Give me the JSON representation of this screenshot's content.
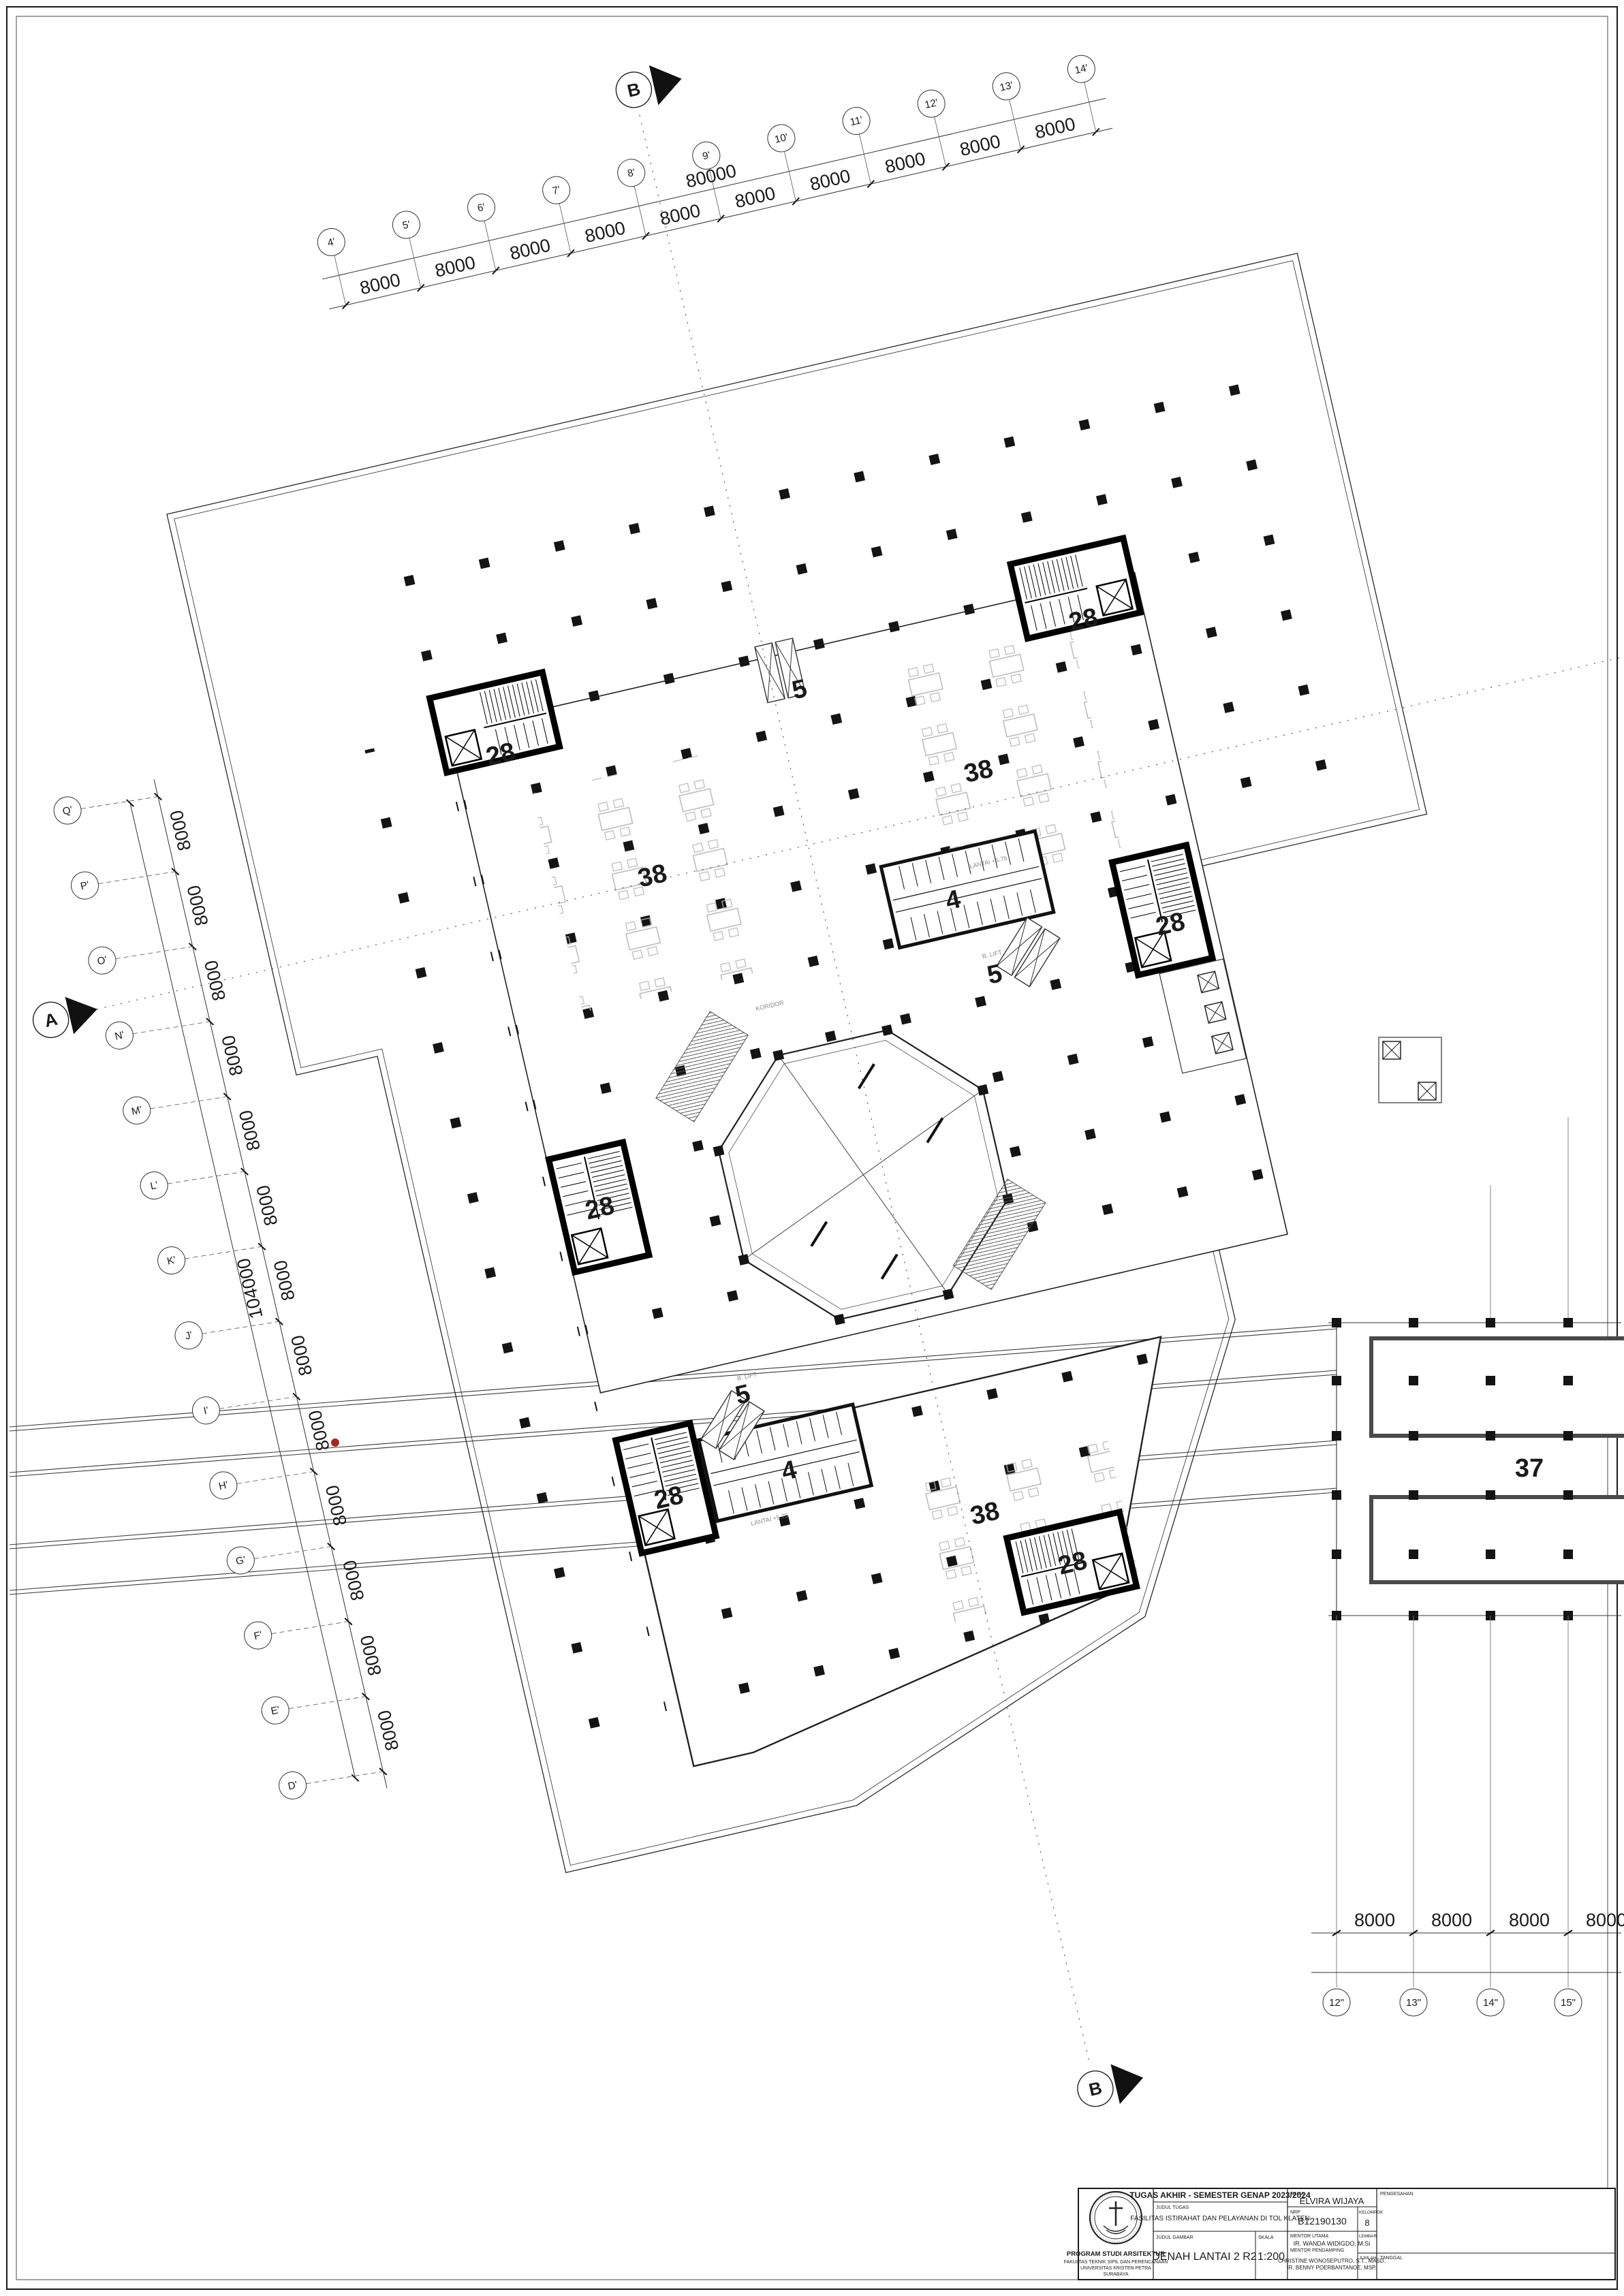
{
  "sheet": {
    "drawing_type": "architectural-floor-plan",
    "colors": {
      "ink": "#1a1a1a",
      "thin": "#333333",
      "furniture": "#b8b8b8",
      "red_mark": "#9e2b25"
    }
  },
  "plan": {
    "section_a": "A",
    "section_b": "B",
    "rooms": {
      "stair": "28",
      "dining": "38",
      "toilet": "4",
      "escalator": "5",
      "wing": "37"
    },
    "notes": {
      "lift": "B. LIFT",
      "level": "LANTAI +5.75",
      "corridor": "KORIDOR"
    }
  },
  "grid": {
    "bay": "8000",
    "total_left": "104000",
    "total_top": "80000",
    "top_labels": [
      "4'",
      "5'",
      "6'",
      "7'",
      "8'",
      "9'",
      "10'",
      "11'",
      "12'",
      "13'",
      "14'"
    ],
    "left_labels": [
      "Q'",
      "P'",
      "O'",
      "N'",
      "M'",
      "L'",
      "K'",
      "J'",
      "I'",
      "H'",
      "G'",
      "F'",
      "E'",
      "D'"
    ],
    "bottom_labels": [
      "12\"",
      "13\"",
      "14\"",
      "15\""
    ]
  },
  "title_block": {
    "header": "TUGAS AKHIR - SEMESTER GENAP 2023/2024",
    "judul_tugas_label": "JUDUL TUGAS",
    "judul_tugas": "FASILITAS ISTIRAHAT DAN PELAYANAN DI TOL KLATEN",
    "judul_gambar_label": "JUDUL GAMBAR",
    "judul_gambar": "DENAH LANTAI 2 R2",
    "skala_label": "SKALA",
    "skala": "1:200",
    "nama_label": "NAMA",
    "nama": "ELVIRA WIJAYA",
    "nrp_label": "NRP",
    "nrp": "B12190130",
    "kelompok_label": "KELOMPOK",
    "kelompok": "8",
    "mentor_utama_label": "MENTOR UTAMA",
    "mentor_utama": "IR. WANDA WIDIGDO, M.Si",
    "mentor_pendamping_label": "MENTOR PENDAMPING",
    "mentor_pendamping_1": "CHRISTINE WONOSEPUTRO, S.T., MASD.",
    "mentor_pendamping_2": "IR. BENNY POERBANTANOE, MSP.",
    "pengesahan_label": "PENGESAHAN",
    "lembar_label": "LEMBAR",
    "jumlah_label": "JUMLAH",
    "tanggal_label": "TANGGAL",
    "institution_1": "PROGRAM STUDI ARSITEKTUR",
    "institution_2": "FAKULTAS TEKNIK SIPIL DAN PERENCANAAN",
    "institution_3": "UNIVERSITAS KRISTEN PETRA",
    "institution_4": "SURABAYA"
  }
}
